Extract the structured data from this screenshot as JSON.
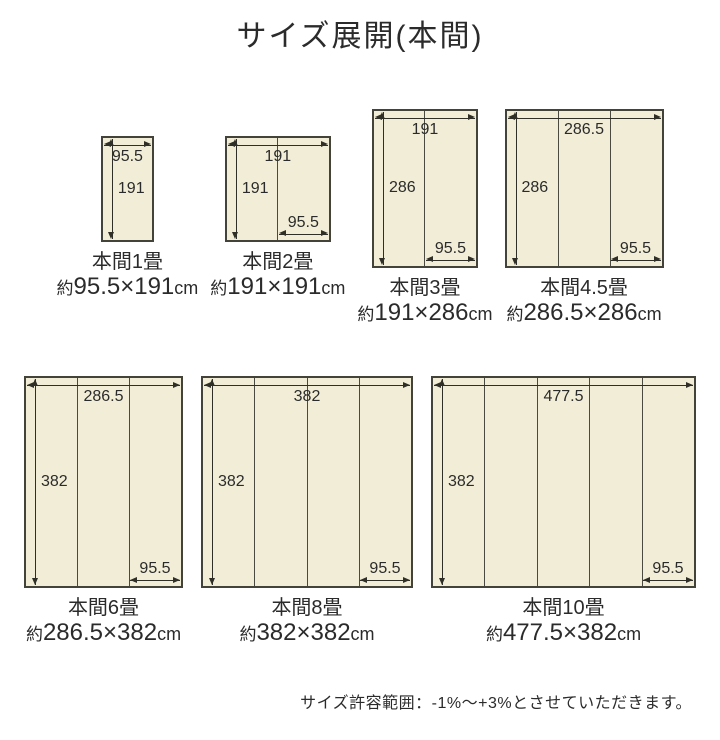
{
  "title": "サイズ展開(本間)",
  "note": "サイズ許容範囲：-1%〜+3%とさせていただきます。",
  "colors": {
    "background": "#ffffff",
    "mat_fill": "#f1edd7",
    "mat_border": "#43433a",
    "panel_divider": "#4a4a40",
    "arrow_line": "#2f2f28",
    "text": "#2b2b2b"
  },
  "unit": "cm",
  "approx_prefix": "約",
  "rows": [
    {
      "mats": [
        {
          "name": "本間1畳",
          "size_value": "95.5×191",
          "size_unit": "cm",
          "width_cm": 95.5,
          "height_cm": 191,
          "panels": 1,
          "width_label": "95.5",
          "height_label": "191",
          "panel_label": null
        },
        {
          "name": "本間2畳",
          "size_value": "191×191",
          "size_unit": "cm",
          "width_cm": 191,
          "height_cm": 191,
          "panels": 2,
          "width_label": "191",
          "height_label": "191",
          "panel_label": "95.5"
        },
        {
          "name": "本間3畳",
          "size_value": "191×286",
          "size_unit": "cm",
          "width_cm": 191,
          "height_cm": 286,
          "panels": 2,
          "width_label": "191",
          "height_label": "286",
          "panel_label": "95.5"
        },
        {
          "name": "本間4.5畳",
          "size_value": "286.5×286",
          "size_unit": "cm",
          "width_cm": 286.5,
          "height_cm": 286,
          "panels": 3,
          "width_label": "286.5",
          "height_label": "286",
          "panel_label": "95.5"
        }
      ]
    },
    {
      "mats": [
        {
          "name": "本間6畳",
          "size_value": "286.5×382",
          "size_unit": "cm",
          "width_cm": 286.5,
          "height_cm": 382,
          "panels": 3,
          "width_label": "286.5",
          "height_label": "382",
          "panel_label": "95.5"
        },
        {
          "name": "本間8畳",
          "size_value": "382×382",
          "size_unit": "cm",
          "width_cm": 382,
          "height_cm": 382,
          "panels": 4,
          "width_label": "382",
          "height_label": "382",
          "panel_label": "95.5"
        },
        {
          "name": "本間10畳",
          "size_value": "477.5×382",
          "size_unit": "cm",
          "width_cm": 477.5,
          "height_cm": 382,
          "panels": 5,
          "width_label": "477.5",
          "height_label": "382",
          "panel_label": "95.5"
        }
      ]
    }
  ]
}
